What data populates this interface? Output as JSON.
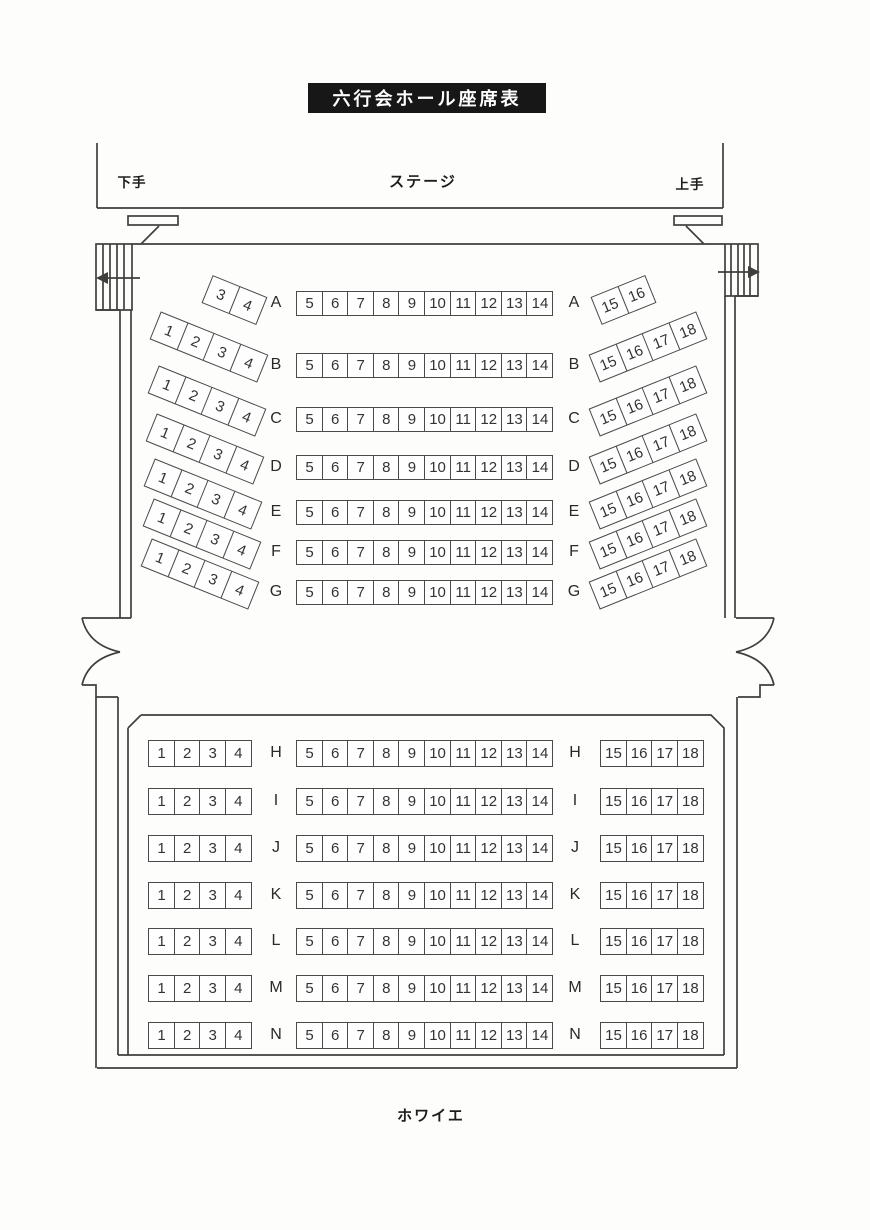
{
  "page": {
    "title": "六行会ホール座席表",
    "stage_label": "ステージ",
    "stage_left_label": "下手",
    "stage_right_label": "上手",
    "foyer_label": "ホワイエ"
  },
  "colors": {
    "banner_bg": "#171717",
    "banner_text": "#ffffff",
    "line": "#3f3f3f",
    "seat_border": "#4a4a4a",
    "text": "#2c2c2c",
    "paper": "#fdfdfc"
  },
  "icons": {
    "exit_left": "arrow-left",
    "exit_right": "arrow-right"
  },
  "front_section": {
    "rows": [
      {
        "letter": "A",
        "left": [
          "3",
          "4"
        ],
        "center": [
          "5",
          "6",
          "7",
          "8",
          "9",
          "10",
          "11",
          "12",
          "13",
          "14"
        ],
        "right": [
          "15",
          "16"
        ]
      },
      {
        "letter": "B",
        "left": [
          "1",
          "2",
          "3",
          "4"
        ],
        "center": [
          "5",
          "6",
          "7",
          "8",
          "9",
          "10",
          "11",
          "12",
          "13",
          "14"
        ],
        "right": [
          "15",
          "16",
          "17",
          "18"
        ]
      },
      {
        "letter": "C",
        "left": [
          "1",
          "2",
          "3",
          "4"
        ],
        "center": [
          "5",
          "6",
          "7",
          "8",
          "9",
          "10",
          "11",
          "12",
          "13",
          "14"
        ],
        "right": [
          "15",
          "16",
          "17",
          "18"
        ]
      },
      {
        "letter": "D",
        "left": [
          "1",
          "2",
          "3",
          "4"
        ],
        "center": [
          "5",
          "6",
          "7",
          "8",
          "9",
          "10",
          "11",
          "12",
          "13",
          "14"
        ],
        "right": [
          "15",
          "16",
          "17",
          "18"
        ]
      },
      {
        "letter": "E",
        "left": [
          "1",
          "2",
          "3",
          "4"
        ],
        "center": [
          "5",
          "6",
          "7",
          "8",
          "9",
          "10",
          "11",
          "12",
          "13",
          "14"
        ],
        "right": [
          "15",
          "16",
          "17",
          "18"
        ]
      },
      {
        "letter": "F",
        "left": [
          "1",
          "2",
          "3",
          "4"
        ],
        "center": [
          "5",
          "6",
          "7",
          "8",
          "9",
          "10",
          "11",
          "12",
          "13",
          "14"
        ],
        "right": [
          "15",
          "16",
          "17",
          "18"
        ]
      },
      {
        "letter": "G",
        "left": [
          "1",
          "2",
          "3",
          "4"
        ],
        "center": [
          "5",
          "6",
          "7",
          "8",
          "9",
          "10",
          "11",
          "12",
          "13",
          "14"
        ],
        "right": [
          "15",
          "16",
          "17",
          "18"
        ]
      }
    ]
  },
  "back_section": {
    "rows": [
      {
        "letter": "H",
        "left": [
          "1",
          "2",
          "3",
          "4"
        ],
        "center": [
          "5",
          "6",
          "7",
          "8",
          "9",
          "10",
          "11",
          "12",
          "13",
          "14"
        ],
        "right": [
          "15",
          "16",
          "17",
          "18"
        ]
      },
      {
        "letter": "I",
        "left": [
          "1",
          "2",
          "3",
          "4"
        ],
        "center": [
          "5",
          "6",
          "7",
          "8",
          "9",
          "10",
          "11",
          "12",
          "13",
          "14"
        ],
        "right": [
          "15",
          "16",
          "17",
          "18"
        ]
      },
      {
        "letter": "J",
        "left": [
          "1",
          "2",
          "3",
          "4"
        ],
        "center": [
          "5",
          "6",
          "7",
          "8",
          "9",
          "10",
          "11",
          "12",
          "13",
          "14"
        ],
        "right": [
          "15",
          "16",
          "17",
          "18"
        ]
      },
      {
        "letter": "K",
        "left": [
          "1",
          "2",
          "3",
          "4"
        ],
        "center": [
          "5",
          "6",
          "7",
          "8",
          "9",
          "10",
          "11",
          "12",
          "13",
          "14"
        ],
        "right": [
          "15",
          "16",
          "17",
          "18"
        ]
      },
      {
        "letter": "L",
        "left": [
          "1",
          "2",
          "3",
          "4"
        ],
        "center": [
          "5",
          "6",
          "7",
          "8",
          "9",
          "10",
          "11",
          "12",
          "13",
          "14"
        ],
        "right": [
          "15",
          "16",
          "17",
          "18"
        ]
      },
      {
        "letter": "M",
        "left": [
          "1",
          "2",
          "3",
          "4"
        ],
        "center": [
          "5",
          "6",
          "7",
          "8",
          "9",
          "10",
          "11",
          "12",
          "13",
          "14"
        ],
        "right": [
          "15",
          "16",
          "17",
          "18"
        ]
      },
      {
        "letter": "N",
        "left": [
          "1",
          "2",
          "3",
          "4"
        ],
        "center": [
          "5",
          "6",
          "7",
          "8",
          "9",
          "10",
          "11",
          "12",
          "13",
          "14"
        ],
        "right": [
          "15",
          "16",
          "17",
          "18"
        ]
      }
    ]
  }
}
